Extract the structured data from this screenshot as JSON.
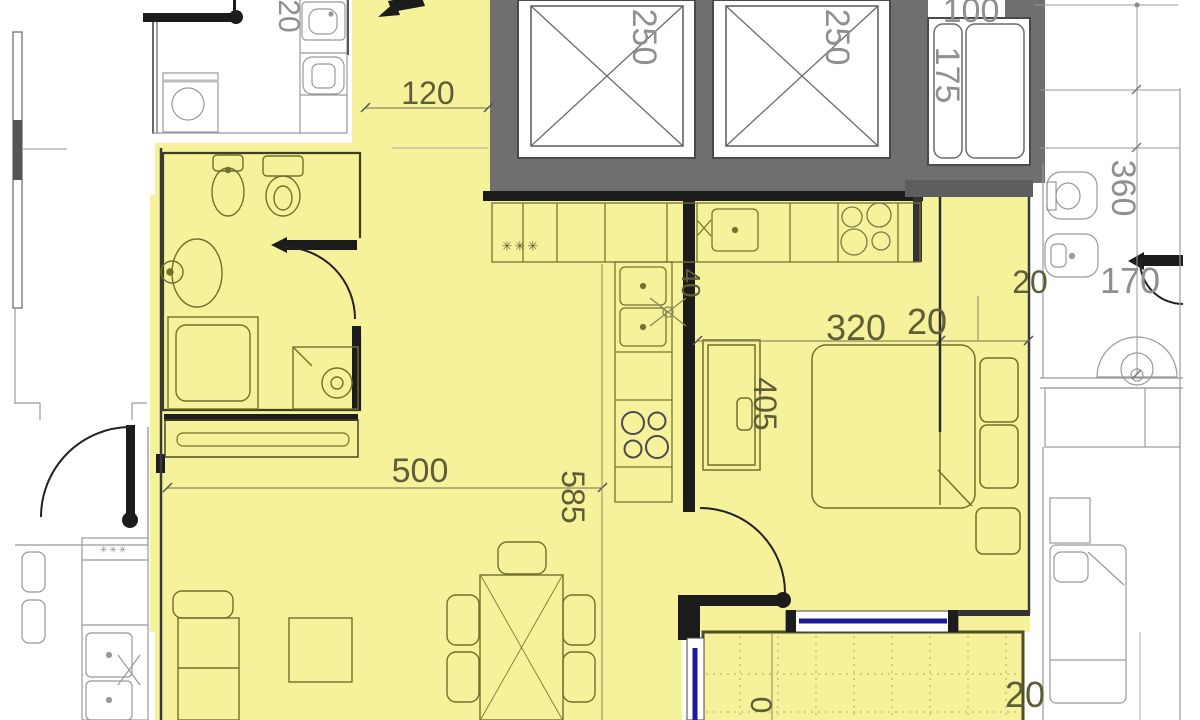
{
  "colors": {
    "apartment_fill": "#f6f29c",
    "core_gray": "#6f6f6f",
    "window_blue": "#1a1a9c"
  },
  "dimensions": {
    "top_left_wall": "20",
    "elevator_left": "250",
    "elevator_right": "250",
    "shaft_width": "100",
    "shaft_depth": "175",
    "hall_width": "120",
    "right_bath_length": "360",
    "right_bath_width": "170",
    "right_wall": "20",
    "kitchen_niche": "40",
    "bedroom_width": "320",
    "bedroom_wall": "20",
    "bedroom_length": "405",
    "living_width": "500",
    "living_length": "585",
    "balcony_wall": "20",
    "balcony_partial": "0"
  },
  "symbols": {
    "kitchen_hob_marks": "✳✳✳",
    "neighbor_hob_marks": "✳✳✳"
  }
}
